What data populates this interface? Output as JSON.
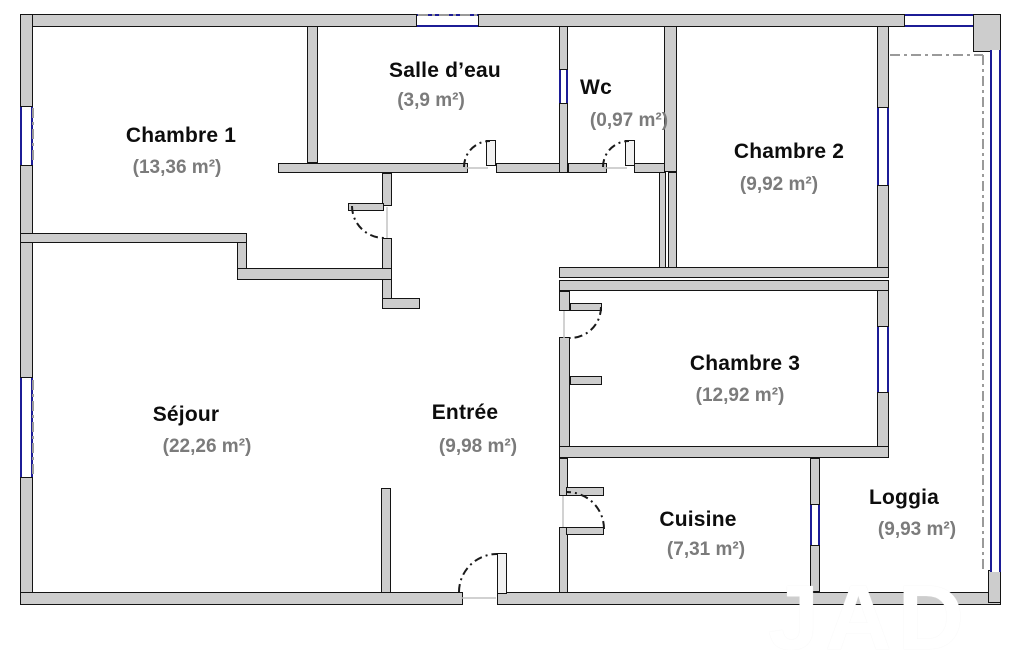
{
  "plan": {
    "rooms": [
      {
        "name": "Chambre 1",
        "area": "(13,36 m²)"
      },
      {
        "name": "Salle d’eau",
        "area": "(3,9 m²)"
      },
      {
        "name": "Wc",
        "area": "(0,97 m²)"
      },
      {
        "name": "Chambre 2",
        "area": "(9,92 m²)"
      },
      {
        "name": "Chambre 3",
        "area": "(12,92 m²)"
      },
      {
        "name": "Séjour",
        "area": "(22,26 m²)"
      },
      {
        "name": "Entrée",
        "area": "(9,98 m²)"
      },
      {
        "name": "Cuisine",
        "area": "(7,31 m²)"
      },
      {
        "name": "Loggia",
        "area": "(9,93 m²)"
      }
    ],
    "watermark": "JAD",
    "colors": {
      "wall_fill": "#cdcdcd",
      "wall_line": "#141414",
      "window_blue": "#1c1c96",
      "area_text": "#7b7b7b",
      "dash_gray": "#9a9a9a"
    }
  }
}
